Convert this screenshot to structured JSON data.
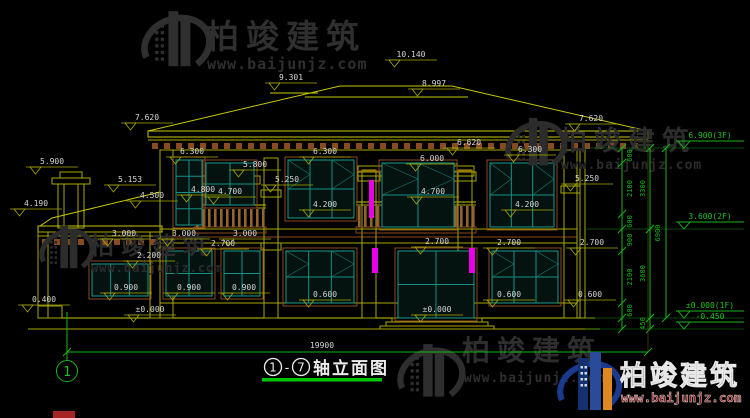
{
  "brand": {
    "name": "柏竣建筑",
    "url": "www.baijunjz.com"
  },
  "title": {
    "axis_from": "1",
    "axis_to": "7",
    "separator": "-",
    "label": "轴立面图"
  },
  "axis_bubble": "1",
  "overall_width_mm": "19900",
  "levels": {
    "f3": "6.900(3F)",
    "f2": "3.600(2F)",
    "f1": "±0.000(1F)",
    "ground": "-0.450"
  },
  "vchain": {
    "inner": [
      "600",
      "2100",
      "600",
      "900",
      "2100",
      "600"
    ],
    "outer": [
      "3300",
      "3600",
      "450"
    ],
    "total": "6900"
  },
  "elevation_marks": [
    {
      "t": "10.140",
      "x": 411,
      "y": 57
    },
    {
      "t": "9.301",
      "x": 291,
      "y": 80
    },
    {
      "t": "8.997",
      "x": 434,
      "y": 86
    },
    {
      "t": "7.620",
      "x": 147,
      "y": 120
    },
    {
      "t": "7.620",
      "x": 591,
      "y": 121
    },
    {
      "t": "6.620",
      "x": 469,
      "y": 145
    },
    {
      "t": "6.300",
      "x": 192,
      "y": 154
    },
    {
      "t": "6.300",
      "x": 325,
      "y": 154
    },
    {
      "t": "6.300",
      "x": 530,
      "y": 152
    },
    {
      "t": "6.000",
      "x": 432,
      "y": 161
    },
    {
      "t": "5.900",
      "x": 52,
      "y": 164
    },
    {
      "t": "5.800",
      "x": 255,
      "y": 167
    },
    {
      "t": "5.250",
      "x": 287,
      "y": 182
    },
    {
      "t": "5.250",
      "x": 587,
      "y": 181
    },
    {
      "t": "5.153",
      "x": 130,
      "y": 182
    },
    {
      "t": "4.800",
      "x": 203,
      "y": 192
    },
    {
      "t": "4.700",
      "x": 230,
      "y": 194
    },
    {
      "t": "4.700",
      "x": 433,
      "y": 194
    },
    {
      "t": "4.500",
      "x": 152,
      "y": 198
    },
    {
      "t": "4.190",
      "x": 36,
      "y": 206
    },
    {
      "t": "4.200",
      "x": 325,
      "y": 207
    },
    {
      "t": "4.200",
      "x": 527,
      "y": 207
    },
    {
      "t": "3.000",
      "x": 124,
      "y": 236
    },
    {
      "t": "3.000",
      "x": 184,
      "y": 236
    },
    {
      "t": "3.000",
      "x": 245,
      "y": 236
    },
    {
      "t": "2.700",
      "x": 223,
      "y": 246
    },
    {
      "t": "2.700",
      "x": 437,
      "y": 244
    },
    {
      "t": "2.700",
      "x": 509,
      "y": 245
    },
    {
      "t": "2.700",
      "x": 592,
      "y": 245
    },
    {
      "t": "2.200",
      "x": 149,
      "y": 258
    },
    {
      "t": "0.900",
      "x": 126,
      "y": 290
    },
    {
      "t": "0.900",
      "x": 189,
      "y": 290
    },
    {
      "t": "0.900",
      "x": 244,
      "y": 290
    },
    {
      "t": "0.600",
      "x": 325,
      "y": 297
    },
    {
      "t": "0.600",
      "x": 509,
      "y": 297
    },
    {
      "t": "0.600",
      "x": 590,
      "y": 297
    },
    {
      "t": "0.400",
      "x": 44,
      "y": 302
    },
    {
      "t": "±0.000",
      "x": 150,
      "y": 312
    },
    {
      "t": "±0.000",
      "x": 437,
      "y": 312
    }
  ]
}
